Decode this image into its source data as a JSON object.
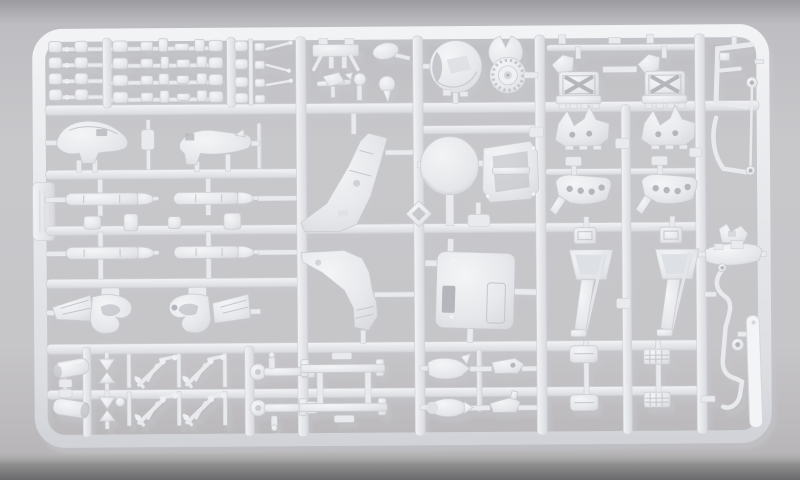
{
  "scene": {
    "type": "photograph",
    "subject": "Injection-moulded light grey plastic model kit sprue (parts tree) photographed on a plain grey surface",
    "plastic_finish": "matte light grey styrene",
    "background": "neutral grey studio surface, darker shaded band along the bottom edge",
    "text_visible": "none"
  },
  "colors": {
    "bg_top": "#9a9a9e",
    "bg_main": "#c8c8cb",
    "bg_lower": "#bcbabc",
    "bg_bottom_band": "#6d6d71",
    "plastic": "#e9eaed",
    "plastic_highlight": "#f5f6f8",
    "plastic_shadow": "#d2d4d9",
    "recess": "#b4b6bc",
    "panel_line": "#c2c5ca",
    "cast_shadow": "#94969e"
  },
  "sprue": {
    "frame": "rounded-rectangle outer runner with an internal grid of horizontal and vertical runners",
    "label_tab": "blank moulded tab on the left outer runner",
    "parts": [
      {
        "name": "pad-grid",
        "count": 3,
        "desc": "rows of small mounting pads and clips along the top band"
      },
      {
        "name": "engine-cradle",
        "count": 1
      },
      {
        "name": "micro-aircraft-part",
        "count": 1
      },
      {
        "name": "control-knob",
        "count": 1
      },
      {
        "name": "oval-fairing",
        "count": 1
      },
      {
        "name": "ball-joint",
        "count": 1
      },
      {
        "name": "dome-shell",
        "count": 1
      },
      {
        "name": "notched-disc-wheel",
        "count": 1
      },
      {
        "name": "ejection-seat",
        "count": 2
      },
      {
        "name": "wing-rib",
        "count": 2
      },
      {
        "name": "flap-plate",
        "count": 2
      },
      {
        "name": "landing-gear-trunk",
        "count": 2
      },
      {
        "name": "equipment-box",
        "count": 2
      },
      {
        "name": "waffle-plate",
        "count": 2
      },
      {
        "name": "fuselage-half-upper",
        "count": 1
      },
      {
        "name": "fuselage-half-lower",
        "count": 1
      },
      {
        "name": "drop-tank",
        "count": 4
      },
      {
        "name": "pylon-pad",
        "count": 4
      },
      {
        "name": "air-intake",
        "count": 2
      },
      {
        "name": "tail-fin-half",
        "count": 2
      },
      {
        "name": "link-diamond",
        "count": 1
      },
      {
        "name": "wheel-disc-large",
        "count": 1
      },
      {
        "name": "cockpit-tub",
        "count": 1
      },
      {
        "name": "access-hatch-panel",
        "count": 1
      },
      {
        "name": "clamp-bracket",
        "count": 1
      },
      {
        "name": "boat-fairing",
        "count": 1
      },
      {
        "name": "canopy-frame",
        "count": 2
      },
      {
        "name": "wire-rod",
        "count": 1
      },
      {
        "name": "antenna-blade",
        "count": 1
      },
      {
        "name": "small-ring",
        "count": 1
      },
      {
        "name": "exhaust-nozzle",
        "count": 2
      },
      {
        "name": "x-brace",
        "count": 2
      },
      {
        "name": "landing-gear-strut",
        "count": 4
      },
      {
        "name": "cannon-barrel",
        "count": 2
      },
      {
        "name": "boarding-ladder-frame",
        "count": 1
      },
      {
        "name": "sensor-pod",
        "count": 4
      },
      {
        "name": "sprue-label-tab",
        "count": 1
      }
    ]
  }
}
